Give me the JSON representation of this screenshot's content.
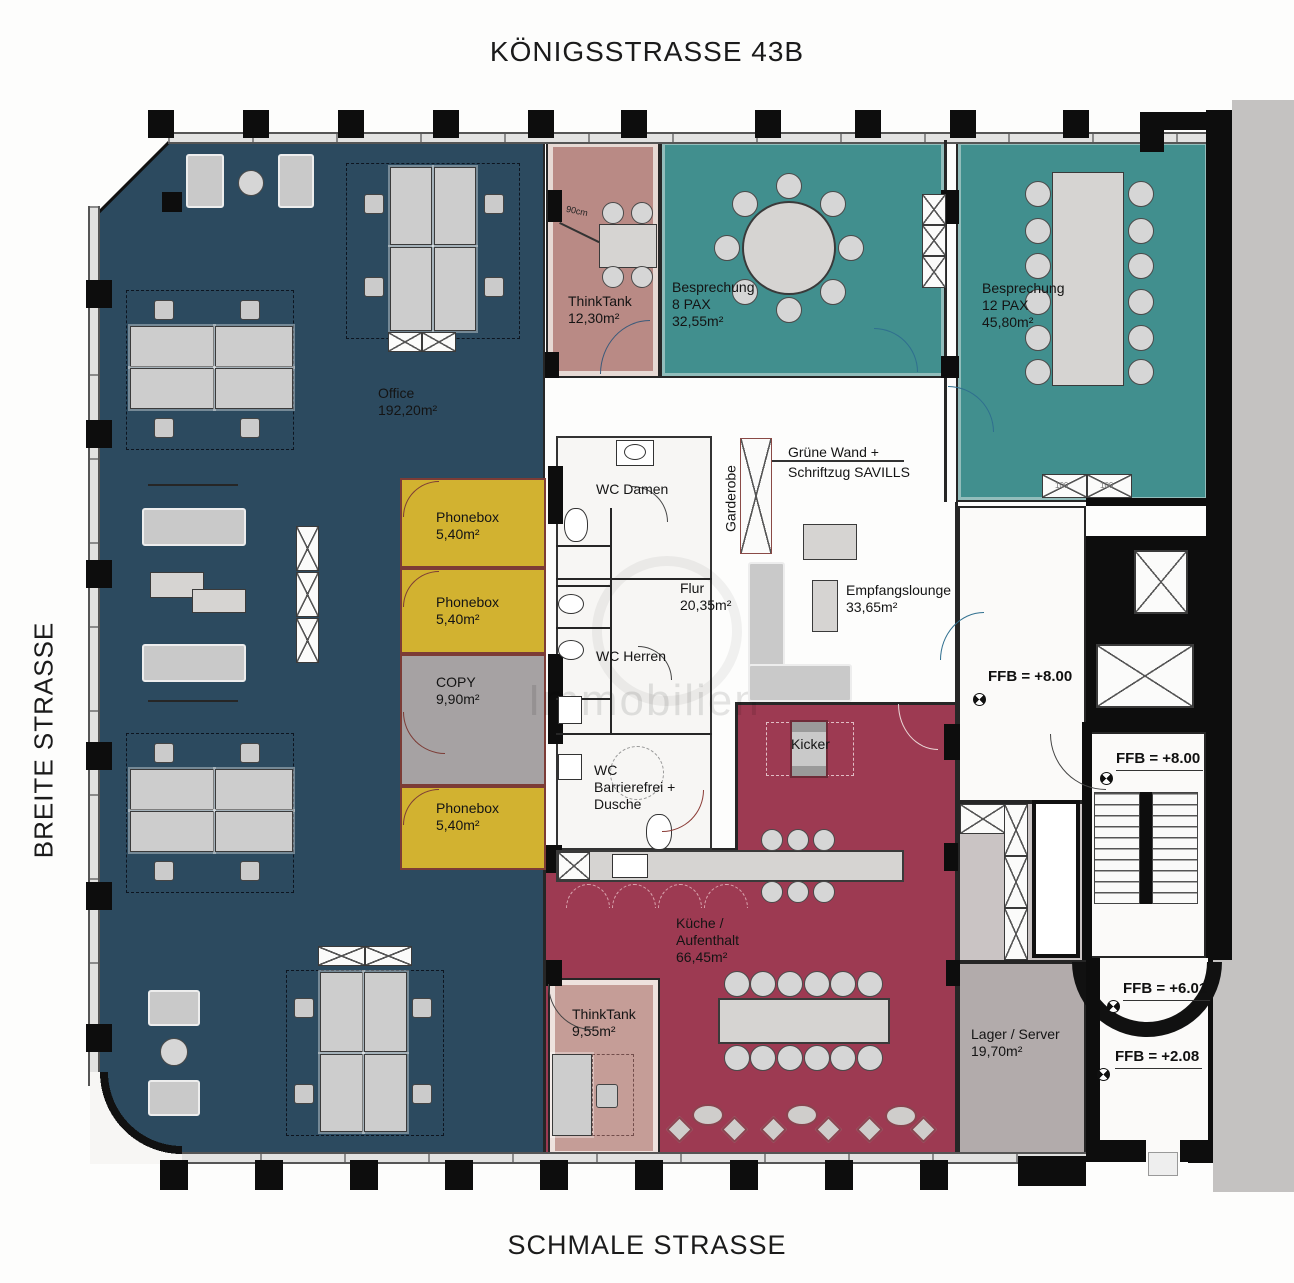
{
  "title": "KÖNIGSSTRASSE 43B",
  "streets": {
    "left": "BREITE STRASSE",
    "bottom": "SCHMALE STRASSE"
  },
  "watermark": "Immobilien",
  "rooms": {
    "office": {
      "name": "Office",
      "area": "192,20m²"
    },
    "thinktank_top": {
      "name": "ThinkTank",
      "area": "12,30m²"
    },
    "besprechung_8": {
      "name": "Besprechung",
      "pax": "8 PAX",
      "area": "32,55m²"
    },
    "besprechung_12": {
      "name": "Besprechung",
      "pax": "12 PAX",
      "area": "45,80m²"
    },
    "phonebox_1": {
      "name": "Phonebox",
      "area": "5,40m²"
    },
    "phonebox_2": {
      "name": "Phonebox",
      "area": "5,40m²"
    },
    "phonebox_3": {
      "name": "Phonebox",
      "area": "5,40m²"
    },
    "copy": {
      "name": "COPY",
      "area": "9,90m²"
    },
    "wc_damen": {
      "name": "WC Damen"
    },
    "wc_herren": {
      "name": "WC Herren"
    },
    "wc_barrierefrei": {
      "line1": "WC",
      "line2": "Barrierefrei +",
      "line3": "Dusche"
    },
    "flur": {
      "name": "Flur",
      "area": "20,35m²"
    },
    "garderobe": {
      "name": "Garderobe"
    },
    "gruene_wand": {
      "line1": "Grüne Wand +",
      "line2": "Schriftzug SAVILLS"
    },
    "empfangslounge": {
      "name": "Empfangslounge",
      "area": "33,65m²"
    },
    "kicker": {
      "name": "Kicker"
    },
    "kueche": {
      "line1": "Küche /",
      "line2": "Aufenthalt",
      "area": "66,45m²"
    },
    "thinktank_bottom": {
      "name": "ThinkTank",
      "area": "9,55m²"
    },
    "lager": {
      "name": "Lager / Server",
      "area": "19,70m²"
    }
  },
  "levels": {
    "ffb_upper_room": "FFB = +8.00",
    "ffb_stair_mid": "FFB = +8.00",
    "ffb_stair_601": "FFB = +6.01",
    "ffb_stair_208": "FFB = +2.08"
  },
  "annotations": {
    "dim_90cm": "90cm",
    "sideboard_width": "100"
  },
  "colors": {
    "office": "#2c4a5f",
    "meeting": "#418f8e",
    "thinktank_top": "#b98a85",
    "thinktank_bottom": "#c59d97",
    "phonebox": "#d2b230",
    "copy": "#a6a2a3",
    "kitchen": "#9d3a52",
    "lager": "#b2abab",
    "outside": "#c4c2c1",
    "wall": "#111111"
  }
}
